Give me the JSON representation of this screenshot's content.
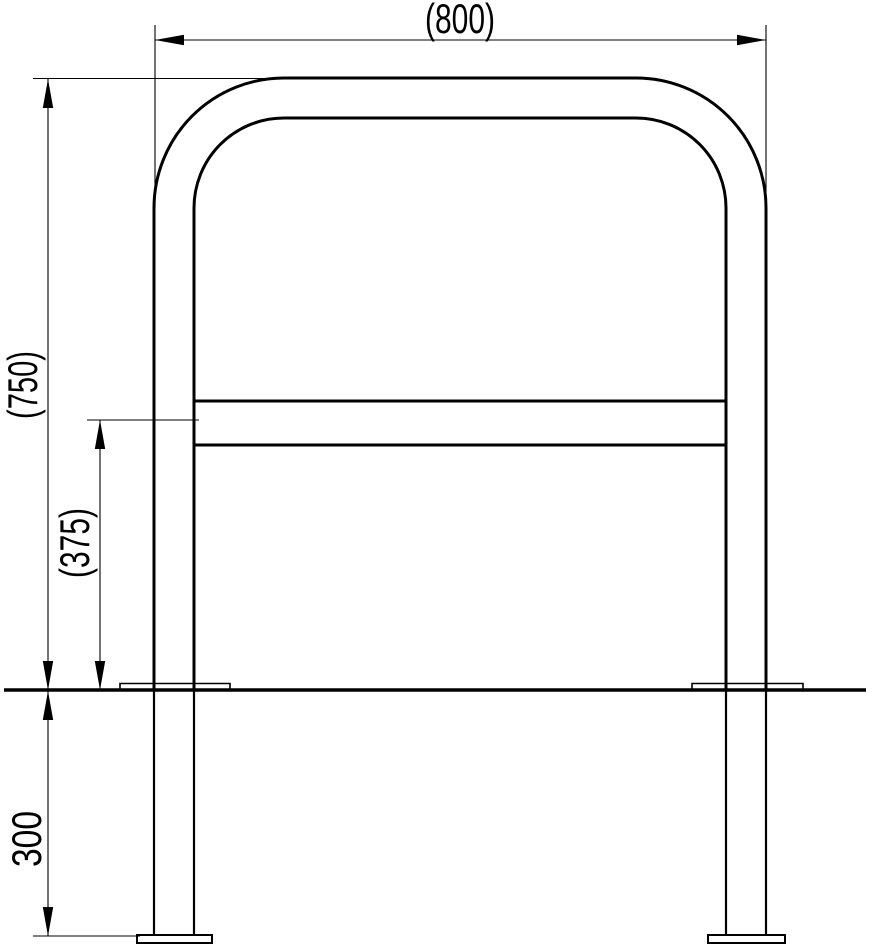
{
  "colors": {
    "line": "#000000",
    "background": "#ffffff"
  },
  "dimensions": {
    "overall_width": {
      "label": "(800)"
    },
    "overall_height": {
      "label": "(750)"
    },
    "crossbar_height": {
      "label": "(375)"
    },
    "embed_depth": {
      "label": "300"
    }
  }
}
